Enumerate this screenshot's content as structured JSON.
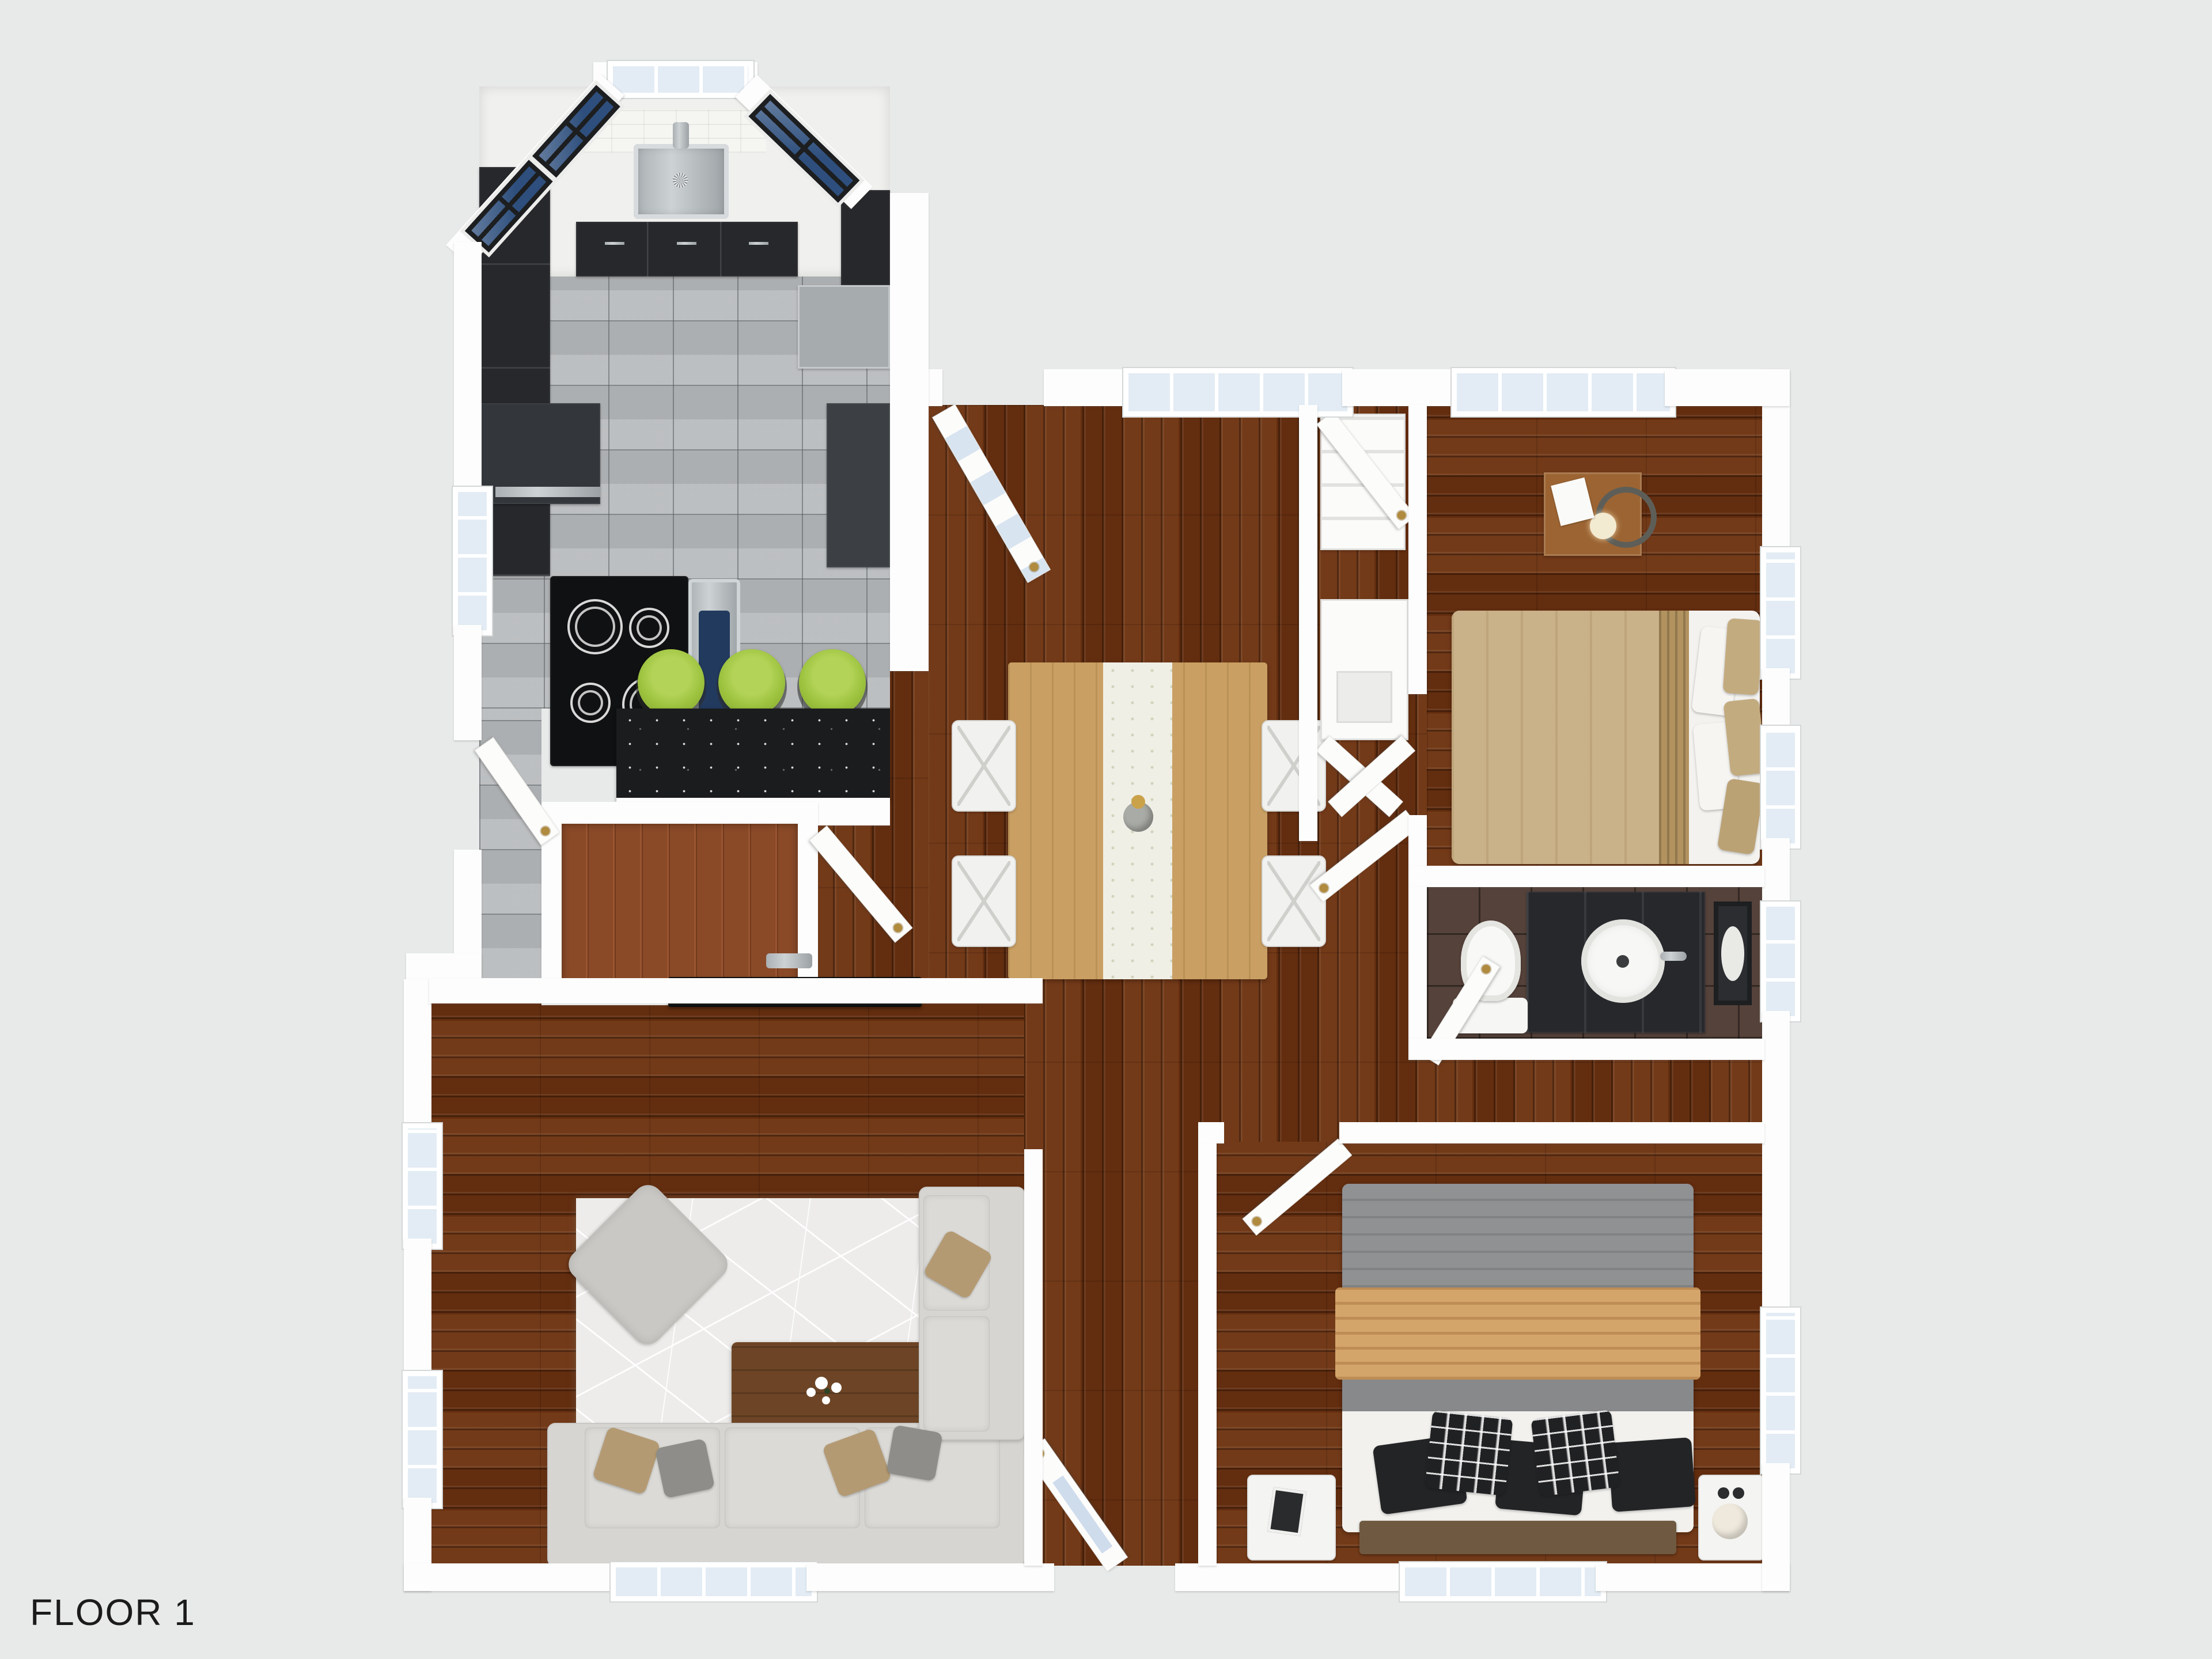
{
  "page": {
    "label": "FLOOR 1",
    "type": "3d-floor-plan-render"
  },
  "palette": {
    "bg": "#e8eaea",
    "wall": "#fdfdfd",
    "wall-edge": "#d6d8d8",
    "wood": "#6b3110",
    "tile": "#b5b8ba",
    "bathtile": "#55423a",
    "counter": "#1b1c1e",
    "cabinet": "#26282b",
    "glass": "#e3ecf4",
    "navy": "#2e4f7d",
    "rug": "#edecea",
    "sofa": "#d6d5d1",
    "stool": "#9cc23e",
    "knob": "#b08a3e",
    "label-color": "#1b1b1b"
  },
  "rooms": [
    {
      "name": "kitchen",
      "floor": "gray-tile",
      "fixtures": [
        "sink",
        "faucet",
        "cooktop",
        "oven",
        "refrigerator",
        "black-cabinets",
        "pantry-cabinet",
        "microwave-shelf",
        "bar-counter",
        "bar-stool",
        "bar-stool",
        "bar-stool"
      ]
    },
    {
      "name": "dining-room",
      "floor": "dark-wood",
      "fixtures": [
        "dining-table",
        "table-runner",
        "vase",
        "chair",
        "chair",
        "chair",
        "chair",
        "back-door-glazed"
      ]
    },
    {
      "name": "living-room",
      "floor": "dark-wood",
      "fixtures": [
        "sectional-sofa",
        "ottoman",
        "coffee-table",
        "flowers",
        "area-rug",
        "wall-tv",
        "throw-pillows"
      ]
    },
    {
      "name": "bedroom-1",
      "floor": "dark-wood",
      "fixtures": [
        "double-bed-tan",
        "pillows",
        "nightstand-wood",
        "lamp"
      ]
    },
    {
      "name": "bedroom-2",
      "floor": "dark-wood",
      "fixtures": [
        "double-bed-gray-tan",
        "checkered-pillows",
        "black-pillows",
        "headboard",
        "nightstand-white-left",
        "nightstand-white-right",
        "sphere-lamp"
      ]
    },
    {
      "name": "bathroom",
      "floor": "brown-tile",
      "fixtures": [
        "vanity-black",
        "round-sink",
        "mirror",
        "toilet"
      ]
    },
    {
      "name": "hallway",
      "floor": "dark-wood",
      "fixtures": [
        "closet",
        "closet",
        "closet-doors"
      ]
    },
    {
      "name": "stairs",
      "fixtures": [
        "wood-steps",
        "door"
      ]
    },
    {
      "name": "entry",
      "fixtures": [
        "front-door-glazed"
      ]
    }
  ],
  "doors": [
    "front-door",
    "back-door",
    "side-door",
    "stair-door",
    "bedroom-1-door",
    "bedroom-2-door",
    "bathroom-door",
    "closet-door"
  ],
  "windows_count": 14
}
